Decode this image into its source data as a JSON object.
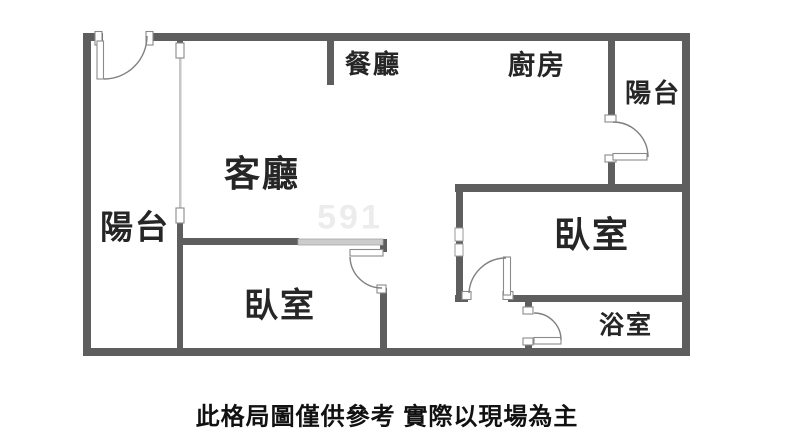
{
  "rooms": {
    "dining": "餐廳",
    "kitchen": "廚房",
    "balcony_right": "陽台",
    "living": "客廳",
    "balcony_left": "陽台",
    "bedroom_left": "臥室",
    "bedroom_right": "臥室",
    "bathroom": "浴室"
  },
  "caption": "此格局圖僅供參考 實際以現場為主",
  "watermark": "591",
  "colors": {
    "wall": "#5e5e5e",
    "door-line": "#8a8a8a",
    "light-wall": "#cccccc",
    "label": "#262626",
    "caption": "#111111",
    "watermark": "#ececec"
  }
}
